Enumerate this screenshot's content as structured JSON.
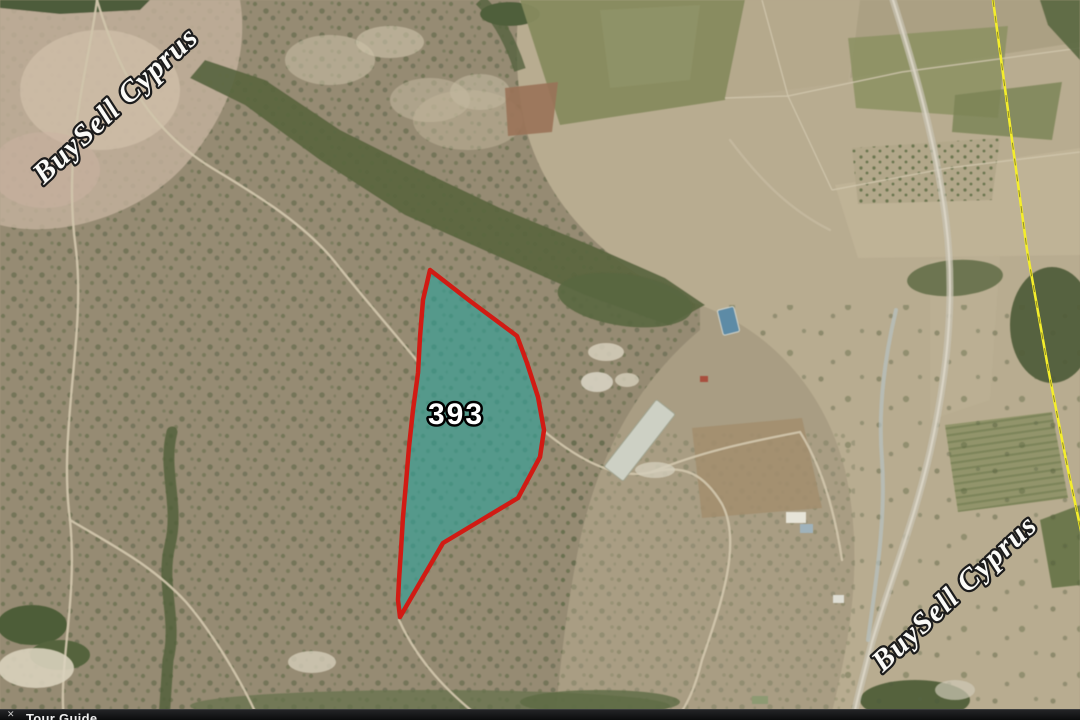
{
  "watermarks": {
    "top_left": "BuySell Cyprus",
    "bottom_right": "BuySell Cyprus"
  },
  "parcel": {
    "label": "393",
    "fill_color": "#2da29a",
    "border_color": "#d11b14"
  },
  "map_lines": {
    "district_boundary_color": "#f4ee2b"
  },
  "bottom_bar": {
    "close_icon": "✕",
    "tour_guide_label": "Tour Guide"
  }
}
